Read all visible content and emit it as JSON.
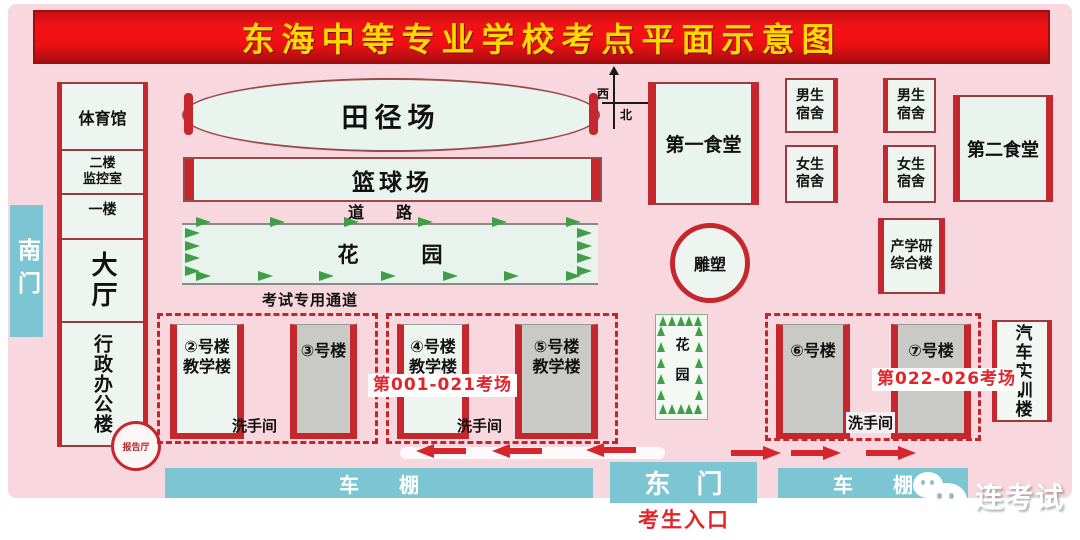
{
  "title": "东海中等专业学校考点平面示意图",
  "compass": {
    "west": "西",
    "north": "北"
  },
  "south_gate": "南门",
  "admin_block": {
    "gym": "体育馆",
    "monitor_room": "二楼\n监控室",
    "first_floor": "一楼",
    "hall": "大厅",
    "admin_office": "行政办公楼",
    "report_hall": "报告厅"
  },
  "grounds": {
    "track_field": "田径场",
    "basketball_court": "篮球场",
    "road": "道　　路",
    "garden_horizontal": "花　　　园",
    "exam_passage": "考试专用通道",
    "garden_vertical": "花园",
    "sculpture": "雕塑"
  },
  "buildings": {
    "canteen_1": "第一食堂",
    "canteen_2": "第二食堂",
    "male_dorm": "男生\n宿舍",
    "female_dorm": "女生\n宿舍",
    "complex": "产学研\n综合楼",
    "auto_training": "汽车实训楼",
    "b2": "②号楼\n教学楼",
    "b3": "③号楼",
    "b4": "④号楼\n教学楼",
    "b5": "⑤号楼\n教学楼",
    "b6": "⑥号楼",
    "b7": "⑦号楼",
    "restroom": "洗手间",
    "exam_rooms_1": "第001-021考场",
    "exam_rooms_2": "第022-026考场"
  },
  "bottom": {
    "bike_shed": "车　　棚",
    "east_gate": "东　门",
    "candidate_entrance": "考生入口"
  },
  "watermark": "连考试",
  "colors": {
    "background_pink": "#f8d7de",
    "accent_red": "#c5272c",
    "banner_red": "#ee1013",
    "title_yellow": "#ffd900",
    "gate_blue": "#7cc6d3",
    "building_mint": "#e9f4ee",
    "building_gray": "#c9c9c6",
    "tree_green": "#3f9f45",
    "exam_text_red": "#e3242b"
  }
}
